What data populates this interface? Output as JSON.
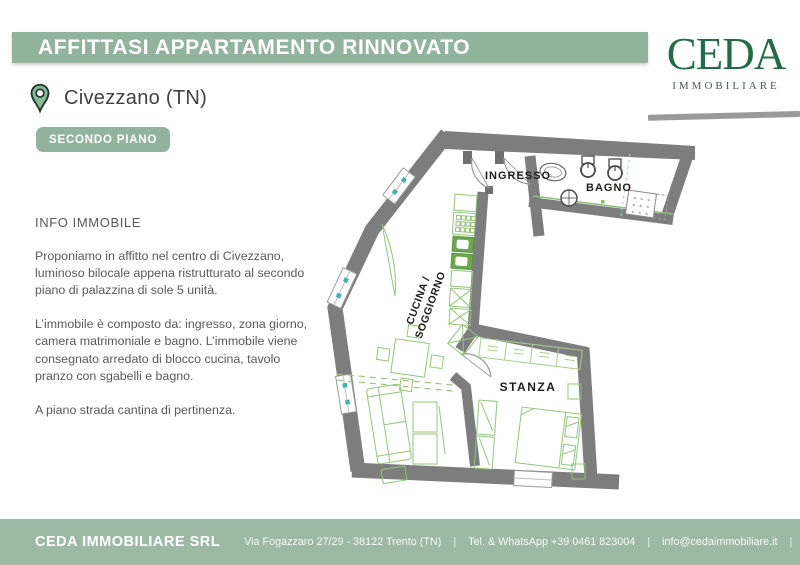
{
  "header": {
    "title": "AFFITTASI APPARTAMENTO RINNOVATO",
    "banner_color": "#92b49d"
  },
  "logo": {
    "name": "CEDA",
    "subtitle": "IMMOBILIARE",
    "color": "#256b49"
  },
  "location": {
    "city": "Civezzano (TN)"
  },
  "floor_badge": {
    "label": "SECONDO PIANO"
  },
  "info": {
    "heading": "INFO IMMOBILE",
    "paragraphs": [
      "Proponiamo in affitto nel centro di Civezzano, luminoso bilocale appena ristrutturato al secondo piano di palazzina di sole 5 unità.",
      "L’immobile è composto da: ingresso, zona giorno, camera matrimoniale e bagno. L’immobile viene consegnato arredato di blocco cucina, tavolo pranzo con sgabelli e bagno.",
      "A piano strada cantina di pertinenza."
    ]
  },
  "floorplan": {
    "labels": {
      "ingresso": "INGRESSO",
      "bagno": "BAGNO",
      "cucina_line1": "CUCINA /",
      "cucina_line2": "SOGGIORNO",
      "stanza": "STANZA"
    },
    "wall_color": "#7d7d7d",
    "furniture_color": "#94c47c",
    "window_dot_color": "#45b3a7"
  },
  "footer": {
    "company": "CEDA IMMOBILIARE SRL",
    "address": "Via Fogazzaro 27/29 - 38122 Trento (TN)",
    "phone": "Tel. & WhatsApp +39 0461 823004",
    "email": "info@cedaimmobiliare.it",
    "website": "www.cedaimmobiliare.it",
    "separator": "|"
  }
}
